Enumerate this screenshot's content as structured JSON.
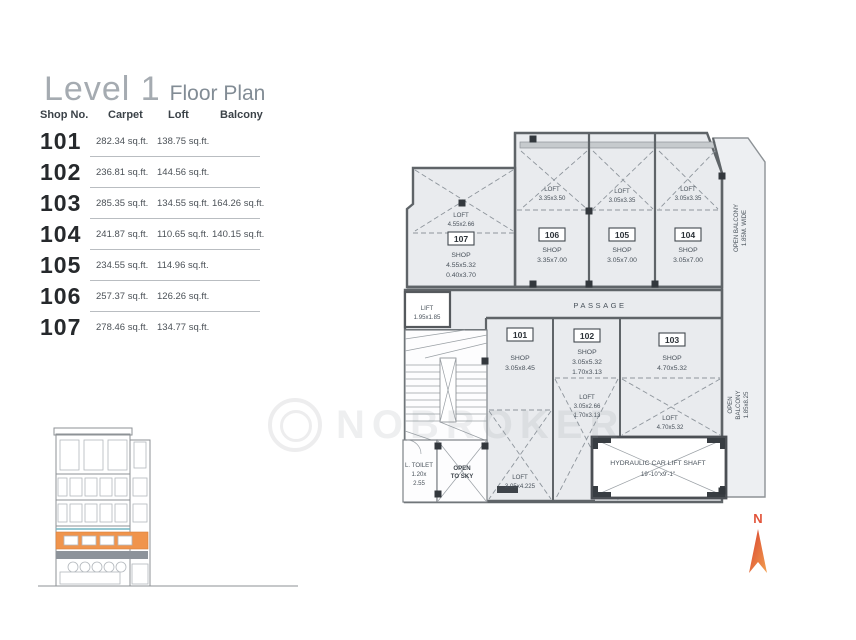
{
  "header": {
    "title": "Level 1",
    "subtitle": "Floor Plan"
  },
  "table": {
    "headers": {
      "shop": "Shop No.",
      "carpet": "Carpet",
      "loft": "Loft",
      "balcony": "Balcony"
    },
    "rows": [
      {
        "shop": "101",
        "carpet": "282.34 sq.ft.",
        "loft": "138.75 sq.ft.",
        "balcony": ""
      },
      {
        "shop": "102",
        "carpet": "236.81 sq.ft.",
        "loft": "144.56 sq.ft.",
        "balcony": ""
      },
      {
        "shop": "103",
        "carpet": "285.35 sq.ft.",
        "loft": "134.55 sq.ft.",
        "balcony": "164.26 sq.ft."
      },
      {
        "shop": "104",
        "carpet": "241.87 sq.ft.",
        "loft": "110.65 sq.ft.",
        "balcony": "140.15 sq.ft."
      },
      {
        "shop": "105",
        "carpet": "234.55 sq.ft.",
        "loft": "114.96 sq.ft.",
        "balcony": ""
      },
      {
        "shop": "106",
        "carpet": "257.37 sq.ft.",
        "loft": "126.26 sq.ft.",
        "balcony": ""
      },
      {
        "shop": "107",
        "carpet": "278.46 sq.ft.",
        "loft": "134.77 sq.ft.",
        "balcony": ""
      }
    ]
  },
  "watermark": {
    "text": "NOBROKER"
  },
  "plan": {
    "passage": "PASSAGE",
    "lift": {
      "l1": "LIFT",
      "l2": "1.95x1.85"
    },
    "toilet": {
      "l1": "L. TOILET",
      "l2": "1.20x",
      "l3": "2.55"
    },
    "open_to_sky": {
      "l1": "OPEN",
      "l2": "TO SKY"
    },
    "hydraulic": {
      "l1": "HYDRAULIC CAR LIFT SHAFT",
      "l2": "19'-10\"x9'-1\""
    },
    "balcony_top": {
      "l1": "OPEN BALCONY",
      "l2": "1.85M. WIDE"
    },
    "balcony_right": {
      "l1": "OPEN",
      "l2": "BALCONY",
      "l3": "1.85x8.25"
    },
    "compass": "N",
    "units": {
      "u101": {
        "no": "101",
        "shop1": "SHOP",
        "shop2": "3.05x8.45",
        "loft1": "LOFT",
        "loft2": "3.05x4.225"
      },
      "u102": {
        "no": "102",
        "shop1": "SHOP",
        "shop2": "3.05x5.32",
        "shop3": "1.70x3.13",
        "loft1": "LOFT",
        "loft2": "3.05x2.66",
        "loft3": "1.70x3.13"
      },
      "u103": {
        "no": "103",
        "shop1": "SHOP",
        "shop2": "4.70x5.32",
        "loft1": "LOFT",
        "loft2": "4.70x5.32"
      },
      "u104": {
        "no": "104",
        "shop1": "SHOP",
        "shop2": "3.05x7.00",
        "loft1": "LOFT",
        "loft2": "3.05x3.35"
      },
      "u105": {
        "no": "105",
        "shop1": "SHOP",
        "shop2": "3.05x7.00",
        "loft1": "LOFT",
        "loft2": "3.05x3.35"
      },
      "u106": {
        "no": "106",
        "shop1": "SHOP",
        "shop2": "3.35x7.00",
        "loft1": "LOFT",
        "loft2": "3.35x3.50"
      },
      "u107": {
        "no": "107",
        "shop1": "SHOP",
        "shop2": "4.55x5.32",
        "shop3": "0.40x3.70",
        "loft1": "LOFT",
        "loft2": "4.55x2.66"
      }
    }
  }
}
